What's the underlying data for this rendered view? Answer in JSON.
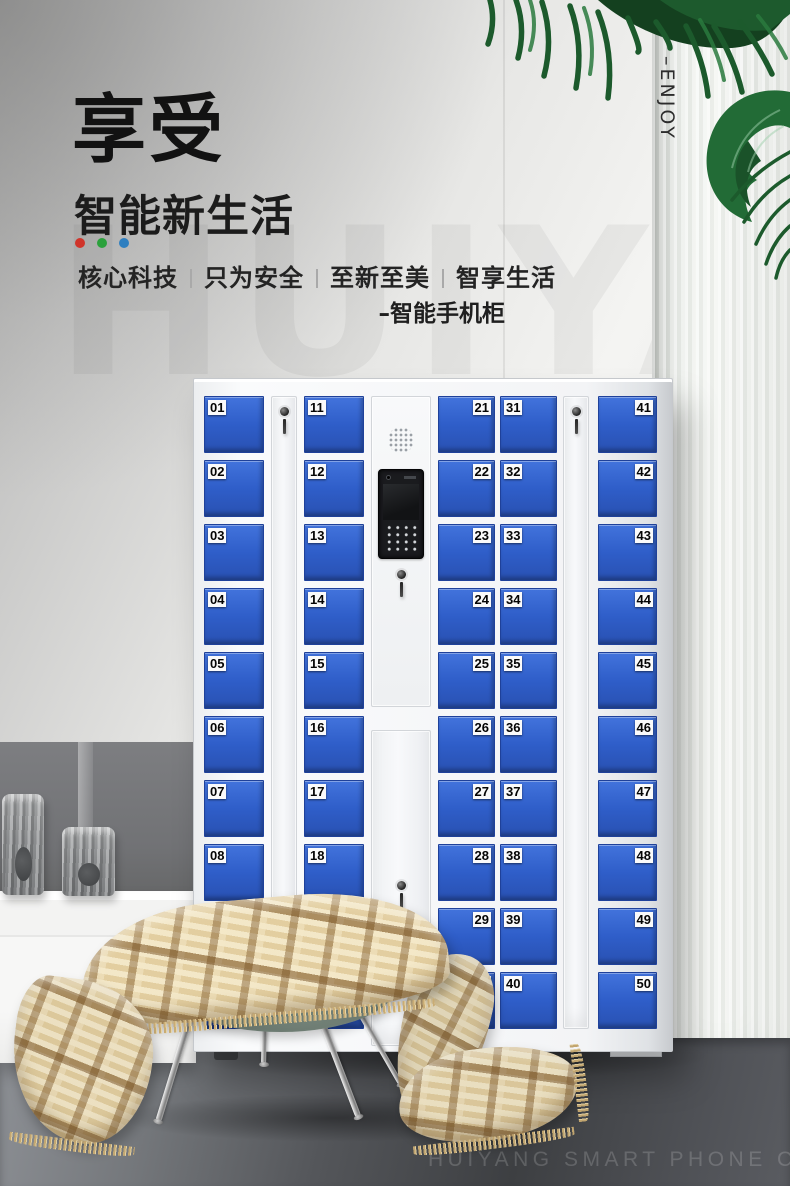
{
  "header": {
    "title_main": "享受",
    "title_sub": "智能新生活",
    "accent_dots": [
      "#d0342a",
      "#2ba13c",
      "#2e7fc0"
    ],
    "tagline_items": [
      "核心科技",
      "只为安全",
      "至新至美",
      "智享生活"
    ],
    "product_label": "–智能手机柜"
  },
  "side_label": "–ENJOY",
  "watermarks": {
    "wall": "HUIYANG",
    "floor": "HUIYANG SMART PHONE CABINET"
  },
  "palette": {
    "door_blue": "#2f5ec9",
    "cabinet_frame": "#f3f4f6",
    "leaf_green": "#1d5a2d",
    "accent_red": "#d0342a",
    "accent_green": "#2ba13c",
    "accent_blue": "#2e7fc0"
  },
  "cabinet": {
    "columns": {
      "c1": {
        "doors": [
          "01",
          "02",
          "03",
          "04",
          "05",
          "06",
          "07",
          "08",
          "",
          ""
        ]
      },
      "c3": {
        "doors": [
          "11",
          "12",
          "13",
          "14",
          "15",
          "16",
          "17",
          "18",
          "19",
          ""
        ]
      },
      "c5": {
        "doors": [
          "21",
          "22",
          "23",
          "24",
          "25",
          "26",
          "27",
          "28",
          "29",
          "30"
        ]
      },
      "c6": {
        "doors": [
          "31",
          "32",
          "33",
          "34",
          "35",
          "36",
          "37",
          "38",
          "39",
          "40"
        ]
      },
      "c8": {
        "doors": [
          "41",
          "42",
          "43",
          "44",
          "45",
          "46",
          "47",
          "48",
          "49",
          "50"
        ]
      }
    }
  }
}
